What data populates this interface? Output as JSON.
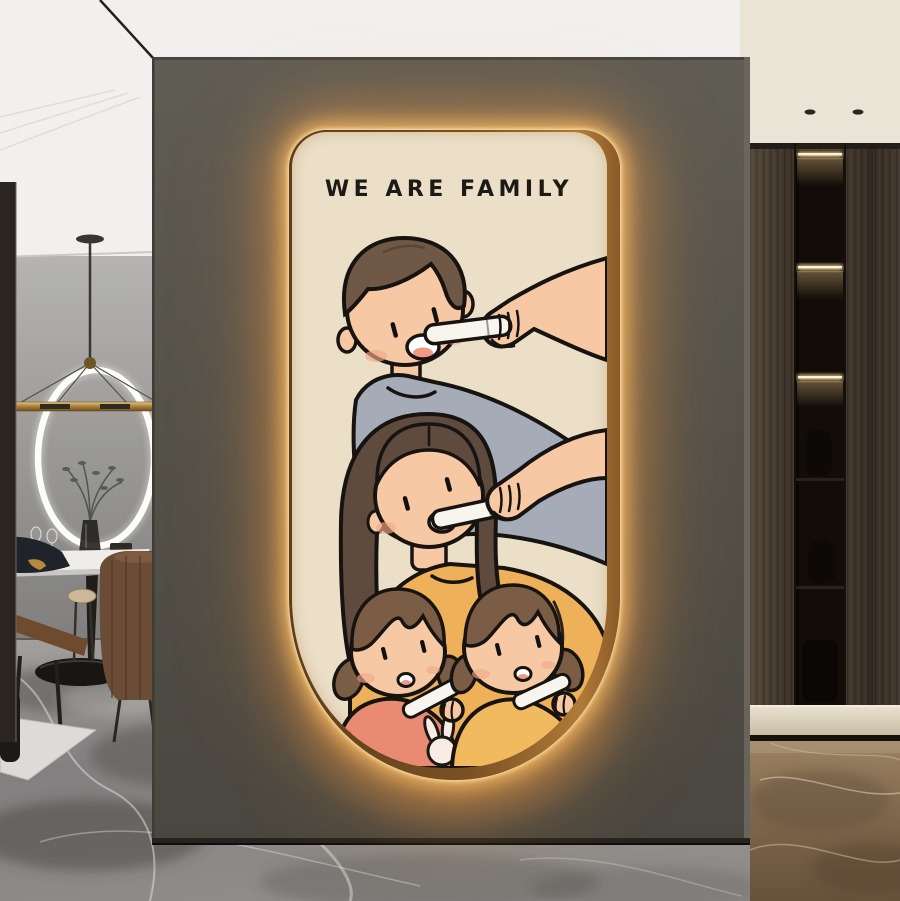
{
  "meta": {
    "scene_label": "LED back-lit arch wall art hung on a charcoal feature wall in a modern interior"
  },
  "artwork": {
    "title": "WE ARE FAMILY",
    "style_label": "cartoon family brushing teeth",
    "canvas_color": "#ebdfc8",
    "outline_color": "#1a1512",
    "glow_color": "#ffb25e",
    "frame_color": "#8a5a28",
    "characters": {
      "boy": {
        "hair": "#6f5846",
        "shirt": "#a6abb8",
        "skin": "#f6c9a4"
      },
      "mom": {
        "hair": "#5f4b3e",
        "shirt": "#eeb058",
        "skin": "#f6c9a4"
      },
      "girl_left": {
        "hair": "#7b5c45",
        "shirt": "#e98a72",
        "shirt_graphic": "bunny"
      },
      "girl_right": {
        "hair": "#7b5c45",
        "shirt": "#f2ba5e"
      }
    },
    "props": [
      "toothbrush",
      "toothbrush",
      "toothbrush",
      "toothbrush"
    ]
  },
  "room": {
    "feature_wall_color": "#56534b",
    "left_area": {
      "wall_color": "#9a9997",
      "floor_marble_color": "#8e8c89",
      "items": [
        "ring-pendant-light",
        "dining-table",
        "plant-in-vase",
        "wine-glasses",
        "upholstered-chair",
        "wooden-chair",
        "stool"
      ]
    },
    "right_area": {
      "wardrobe_wood_color": "#473c31",
      "led_strip_color": "#ffe7b0",
      "baseboard_color": "#ddd3bf",
      "floor_marble_color": "#7d6546",
      "items": [
        "wardrobe-shelving",
        "led-shelf-strips",
        "recessed-spotlights",
        "baseboard"
      ]
    },
    "ceiling_left_color": "#f1f0ee",
    "ceiling_right_color": "#eae4d6"
  }
}
